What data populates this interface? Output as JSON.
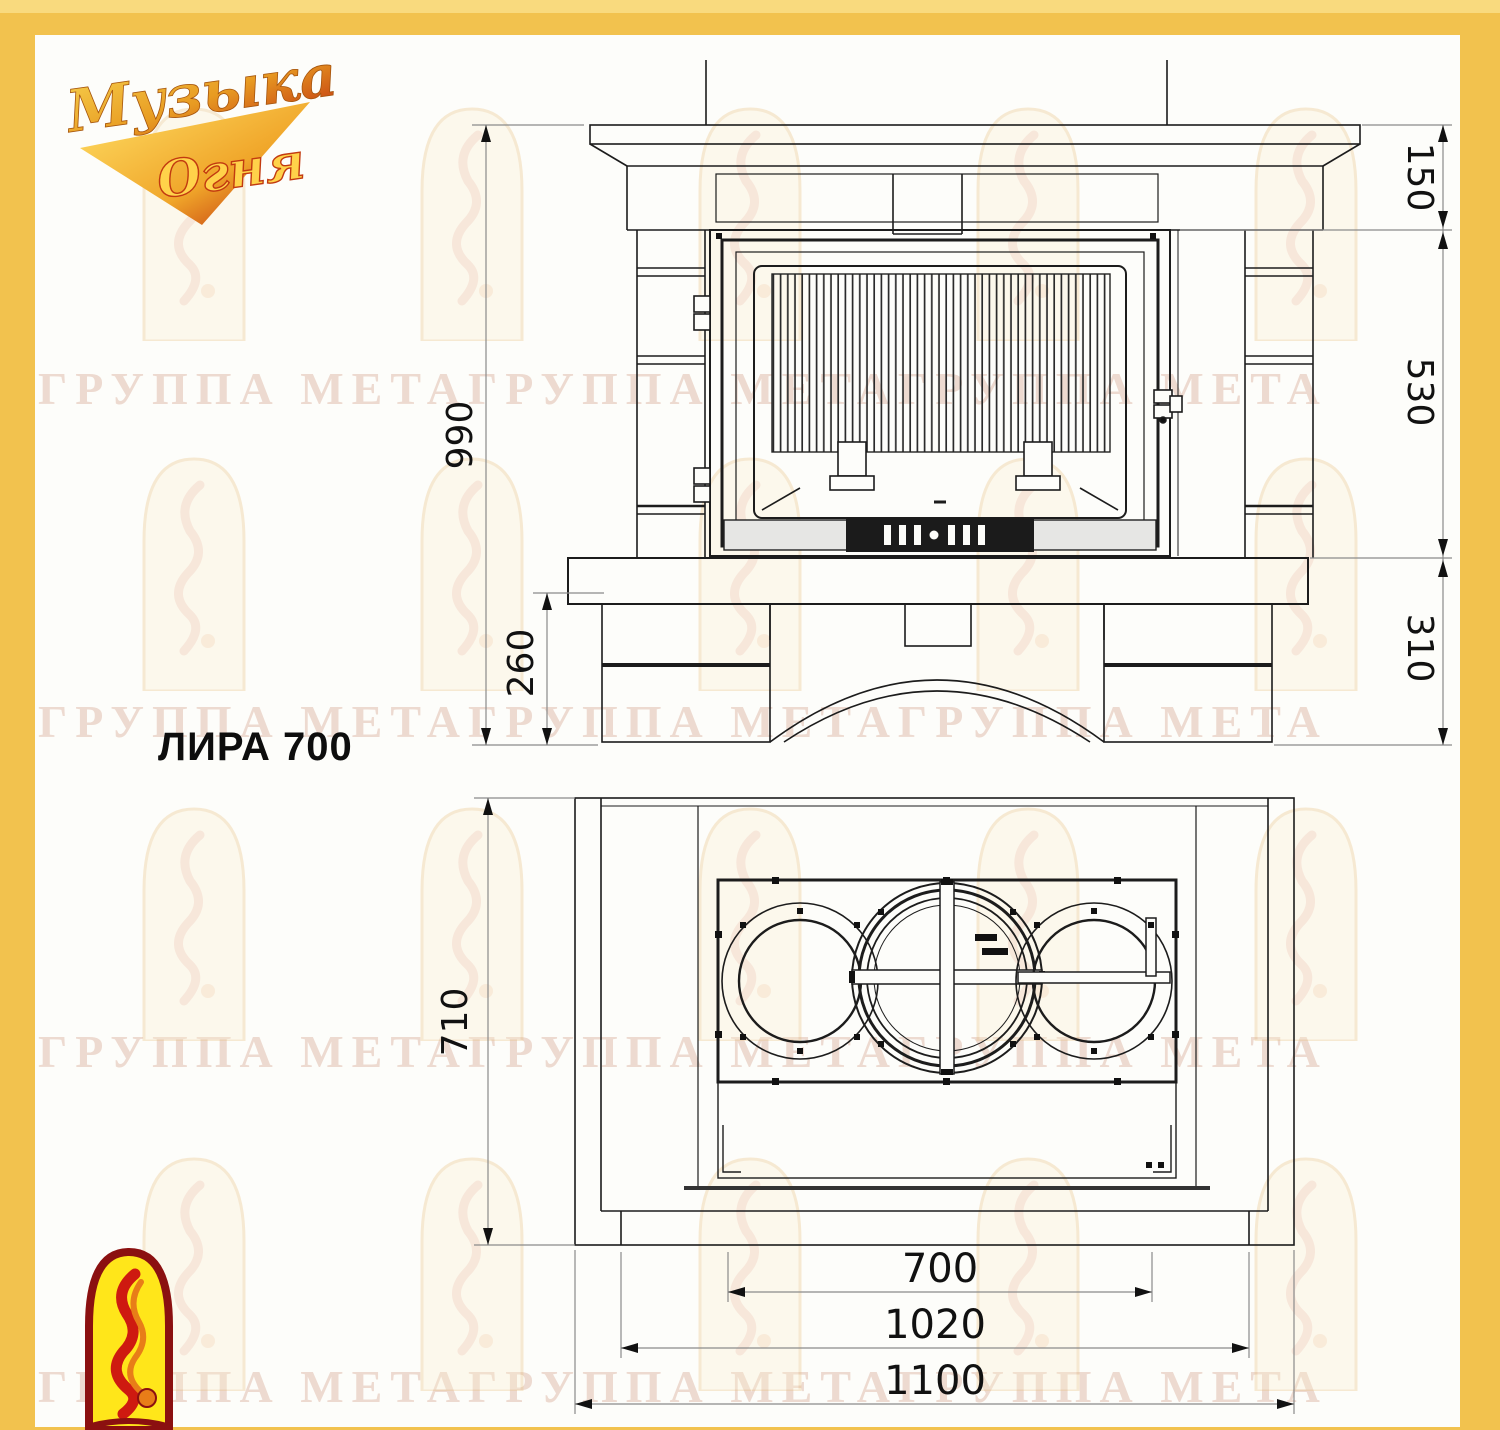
{
  "title": "ЛИРА 700",
  "brand": {
    "logo_text_line1": "Музыка",
    "logo_text_line2": "Огня"
  },
  "watermark": {
    "row_text": "ГРУППА МЕТАГРУППА МЕТАГРУППА МЕТА"
  },
  "colors": {
    "frame": "#F2C24E",
    "frame_light": "#F9DA7E",
    "canvas": "#FDFDFA",
    "line": "#1c1c1c",
    "dim_line": "#8a8a8a",
    "dim_text": "#111111"
  },
  "front_view": {
    "name": "front elevation",
    "dims": {
      "height_total": "990",
      "base_height": "260",
      "mantel_band": "150",
      "firebox_height": "530",
      "plinth_height": "310"
    }
  },
  "plan_view": {
    "name": "plan view",
    "dims": {
      "depth_total": "710",
      "firebox_width": "700",
      "inner_width": "1020",
      "overall_width": "1100"
    }
  }
}
